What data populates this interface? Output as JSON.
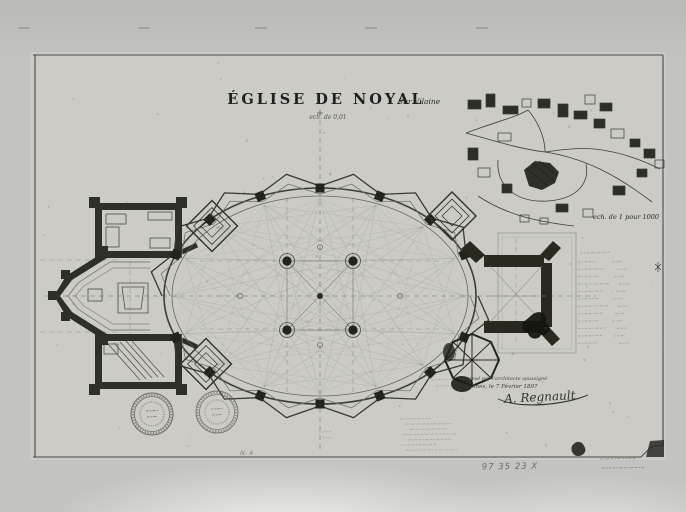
{
  "archive": {
    "inventory_number": "97 35 23 X"
  },
  "drawing": {
    "title": "ÉGLISE DE NOYAL",
    "title_suffix": "Sur Vilaine",
    "scale_note": "ech. de 0,01",
    "site_map_caption": "ech. de 1 pour 1000",
    "pencil_number": "N. 4",
    "signature": {
      "line1": "Dressé par l'architecte soussigné",
      "line2": "Rennes, le 7 Février 1897",
      "name": "A. Regnault"
    }
  },
  "colors": {
    "ink": "#26261f",
    "pencil": "#8f8f87",
    "paper": "#cccbc6",
    "background": "#c3c3c1"
  }
}
